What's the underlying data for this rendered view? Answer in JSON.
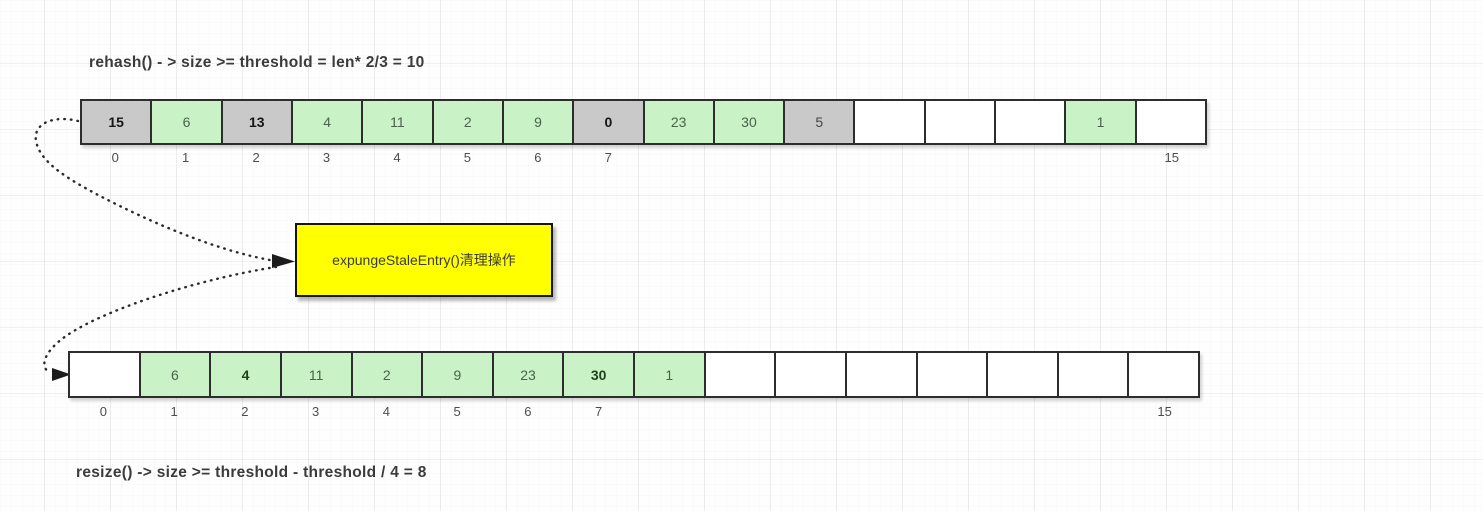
{
  "titles": {
    "top": "rehash() - > size >= threshold = len* 2/3 = 10",
    "bottom": "resize() -> size >= threshold - threshold / 4 = 8"
  },
  "callout": {
    "label": "expungeStaleEntry()清理操作",
    "fill": "#ffff00"
  },
  "colors": {
    "stale": "#c9c9c9",
    "entry": "#c9f2c6",
    "empty": "#ffffff",
    "border": "#2d2d2d"
  },
  "arrays": {
    "top_array": {
      "cells": [
        {
          "value": "15",
          "state": "stale",
          "bold": true,
          "index": "0"
        },
        {
          "value": "6",
          "state": "entry",
          "bold": false,
          "index": "1"
        },
        {
          "value": "13",
          "state": "stale",
          "bold": true,
          "index": "2"
        },
        {
          "value": "4",
          "state": "entry",
          "bold": false,
          "index": "3"
        },
        {
          "value": "11",
          "state": "entry",
          "bold": false,
          "index": "4"
        },
        {
          "value": "2",
          "state": "entry",
          "bold": false,
          "index": "5"
        },
        {
          "value": "9",
          "state": "entry",
          "bold": false,
          "index": "6"
        },
        {
          "value": "0",
          "state": "stale",
          "bold": true,
          "index": "7"
        },
        {
          "value": "23",
          "state": "entry",
          "bold": false,
          "index": ""
        },
        {
          "value": "30",
          "state": "entry",
          "bold": false,
          "index": ""
        },
        {
          "value": "5",
          "state": "stale",
          "bold": false,
          "index": ""
        },
        {
          "value": "",
          "state": "empty",
          "bold": false,
          "index": ""
        },
        {
          "value": "",
          "state": "empty",
          "bold": false,
          "index": ""
        },
        {
          "value": "",
          "state": "empty",
          "bold": false,
          "index": ""
        },
        {
          "value": "1",
          "state": "entry",
          "bold": false,
          "index": ""
        },
        {
          "value": "",
          "state": "empty",
          "bold": false,
          "index": "15"
        }
      ]
    },
    "bottom_array": {
      "cells": [
        {
          "value": "",
          "state": "empty",
          "bold": false,
          "index": "0"
        },
        {
          "value": "6",
          "state": "entry",
          "bold": false,
          "index": "1"
        },
        {
          "value": "4",
          "state": "entry",
          "bold": true,
          "index": "2"
        },
        {
          "value": "11",
          "state": "entry",
          "bold": false,
          "index": "3"
        },
        {
          "value": "2",
          "state": "entry",
          "bold": false,
          "index": "4"
        },
        {
          "value": "9",
          "state": "entry",
          "bold": false,
          "index": "5"
        },
        {
          "value": "23",
          "state": "entry",
          "bold": false,
          "index": "6"
        },
        {
          "value": "30",
          "state": "entry",
          "bold": true,
          "index": "7"
        },
        {
          "value": "1",
          "state": "entry",
          "bold": false,
          "index": ""
        },
        {
          "value": "",
          "state": "empty",
          "bold": false,
          "index": ""
        },
        {
          "value": "",
          "state": "empty",
          "bold": false,
          "index": ""
        },
        {
          "value": "",
          "state": "empty",
          "bold": false,
          "index": ""
        },
        {
          "value": "",
          "state": "empty",
          "bold": false,
          "index": ""
        },
        {
          "value": "",
          "state": "empty",
          "bold": false,
          "index": ""
        },
        {
          "value": "",
          "state": "empty",
          "bold": false,
          "index": ""
        },
        {
          "value": "",
          "state": "empty",
          "bold": false,
          "index": "15"
        }
      ]
    }
  }
}
